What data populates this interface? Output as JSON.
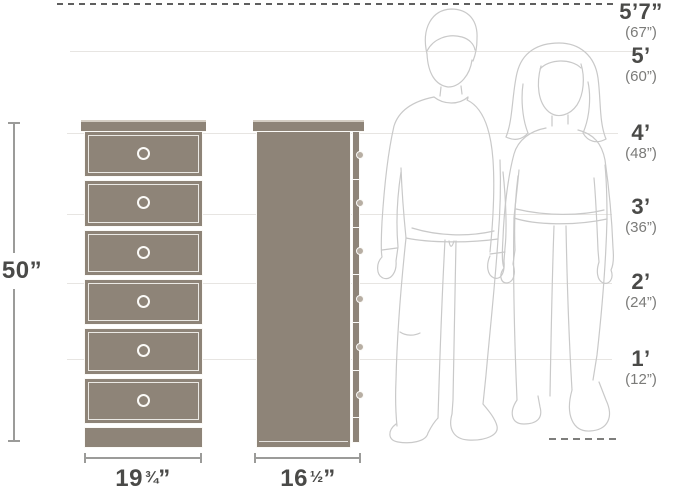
{
  "palette": {
    "dresser_fill": "#8E8478",
    "dresser_cap_highlight": "#D5CEC4",
    "outline_white": "#FBFAF7",
    "reference_line": "#E7E5E2",
    "dashed_line": "#5F5F5F",
    "dimension_line": "#9B9B99",
    "label_primary": "#4A4A48",
    "label_secondary": "#7B7B79",
    "figure_stroke": "#C9C9C9",
    "background": "#FFFFFF"
  },
  "height_scale": {
    "labels": [
      {
        "primary": "5’7”",
        "secondary": "(67”)"
      },
      {
        "primary": "5’",
        "secondary": "(60”)"
      },
      {
        "primary": "4’",
        "secondary": "(48”)"
      },
      {
        "primary": "3’",
        "secondary": "(36”)"
      },
      {
        "primary": "2’",
        "secondary": "(24”)"
      },
      {
        "primary": "1’",
        "secondary": "(12”)"
      }
    ]
  },
  "dimensions": {
    "height": {
      "value": "50”"
    },
    "front_width": {
      "whole": "19",
      "fraction": "¾",
      "unit": "”"
    },
    "side_depth": {
      "whole": "16",
      "fraction": "½",
      "unit": "”"
    }
  },
  "furniture": {
    "drawer_count": 6
  }
}
